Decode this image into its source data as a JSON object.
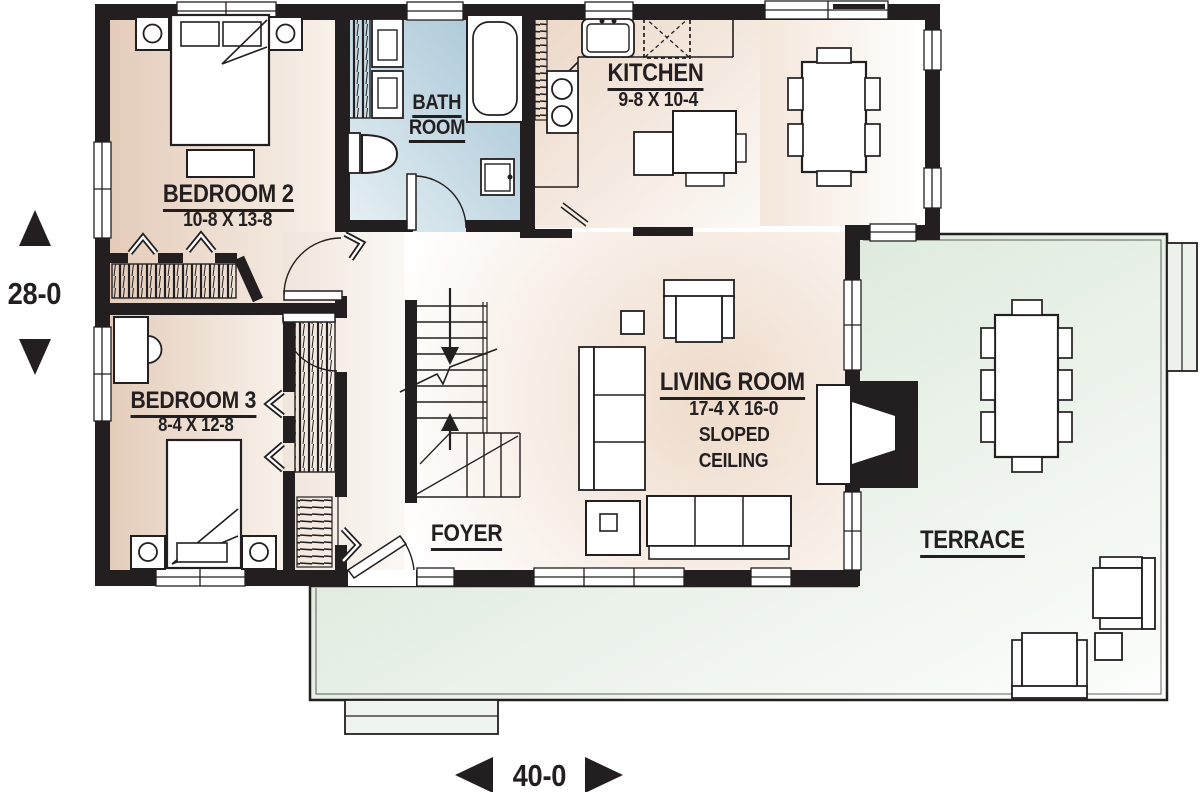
{
  "plan_title": "single-storey house floor plan",
  "rooms": {
    "bedroom2": {
      "name": "BEDROOM 2",
      "dims": "10-8 X 13-8"
    },
    "bathroom": {
      "line1": "BATH",
      "line2": "ROOM"
    },
    "kitchen": {
      "name": "KITCHEN",
      "dims": "9-8 X 10-4"
    },
    "bedroom3": {
      "name": "BEDROOM 3",
      "dims": "8-4 X 12-8"
    },
    "living": {
      "name": "LIVING ROOM",
      "dims": "17-4 X 16-0",
      "note1": "SLOPED",
      "note2": "CEILING"
    },
    "foyer": {
      "name": "FOYER"
    },
    "terrace": {
      "name": "TERRACE"
    }
  },
  "dimensions": {
    "depth": "28-0",
    "width": "40-0"
  },
  "colors": {
    "wall": "#231f20",
    "bedroom_tint": "#e6cfbe",
    "bathroom_tint": "#abc8d8",
    "terrace_tint": "#d4e2d2",
    "paper": "#ffffff"
  },
  "icons": {
    "depth_arrow_up": "triangle-up",
    "depth_arrow_down": "triangle-down",
    "width_arrow_left": "triangle-left",
    "width_arrow_right": "triangle-right",
    "stair_arrows": "up-down"
  }
}
